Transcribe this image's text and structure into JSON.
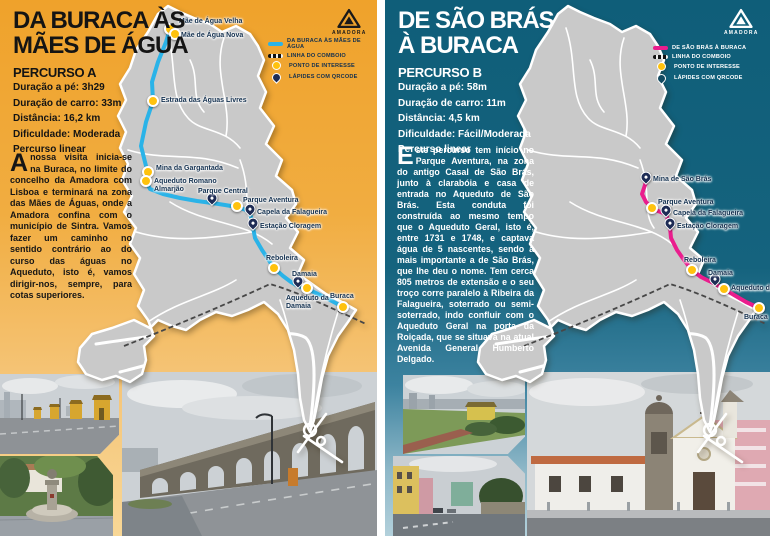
{
  "brand": {
    "logo_label": "AMADORA",
    "logo_icon": "amadora-triangle-emblem"
  },
  "panels": [
    {
      "title_lines": [
        "DA BURACA ÀS",
        "MÃES DE ÁGUA"
      ],
      "subtitle": "PERCURSO A",
      "stats": [
        "Duração a pé: 3h29",
        "Duração de carro: 33m",
        "Distância: 16,2 km",
        "Dificuldade: Moderada",
        "Percurso linear"
      ],
      "description": "A nossa visita inicia-se na Buraca, no limite do concelho da Amadora com Lisboa e terminará na zona das Mães de Águas, onde a Amadora confina com o município de Sintra. Vamos fazer um caminho no sentido contrário ao do curso das águas no Aqueduto, isto é, vamos dirigir-nos, sempre, para cotas superiores.",
      "legend": [
        {
          "symbol": "route",
          "label": "DA BURACA ÀS MÃES DE ÁGUA"
        },
        {
          "symbol": "train",
          "label": "LINHA DO COMBOIO"
        },
        {
          "symbol": "poi",
          "label": "PONTO DE INTERESSE"
        },
        {
          "symbol": "qr",
          "label": "LÁPIDES COM QRCODE"
        }
      ],
      "colors": {
        "route": "#2ab3e8",
        "background": "#efa22b"
      },
      "map": {
        "route": [
          [
            170,
            29
          ],
          [
            166,
            42
          ],
          [
            158,
            62
          ],
          [
            152,
            82
          ],
          [
            153,
            101
          ],
          [
            146,
            122
          ],
          [
            141,
            146
          ],
          [
            146,
            166
          ],
          [
            148,
            172
          ],
          [
            146,
            181
          ],
          [
            150,
            189
          ],
          [
            163,
            194
          ],
          [
            180,
            198
          ],
          [
            197,
            201
          ],
          [
            212,
            203
          ],
          [
            225,
            205
          ],
          [
            237,
            207
          ],
          [
            246,
            210
          ],
          [
            250,
            214
          ],
          [
            252,
            220
          ],
          [
            253,
            227
          ],
          [
            255,
            238
          ],
          [
            262,
            250
          ],
          [
            268,
            259
          ],
          [
            274,
            268
          ],
          [
            283,
            276
          ],
          [
            291,
            282
          ],
          [
            298,
            286
          ],
          [
            307,
            289
          ],
          [
            318,
            294
          ],
          [
            330,
            300
          ],
          [
            343,
            307
          ]
        ],
        "markers": [
          {
            "name": "Mãe de Água Velha",
            "type": "poi",
            "x": 170,
            "y": 29,
            "lx": 179,
            "ly": 18
          },
          {
            "name": "Mãe de Água Nova",
            "type": "poi",
            "x": 175,
            "y": 34,
            "lx": 181,
            "ly": 32
          },
          {
            "name": "Estrada das Águas Livres",
            "type": "poi",
            "x": 153,
            "y": 101,
            "lx": 161,
            "ly": 97
          },
          {
            "name": "Mina da Gargantada",
            "type": "poi",
            "x": 148,
            "y": 172,
            "lx": 156,
            "ly": 165
          },
          {
            "name": "Aqueduto Romano Almarjão",
            "type": "poi",
            "x": 146,
            "y": 181,
            "lx": 154,
            "ly": 178,
            "w": 68
          },
          {
            "name": "Parque Central",
            "type": "qr",
            "x": 212,
            "y": 202,
            "lx": 198,
            "ly": 188
          },
          {
            "name": "Parque Aventura",
            "type": "poi",
            "x": 237,
            "y": 206,
            "lx": 243,
            "ly": 197
          },
          {
            "name": "Capela da Falagueira",
            "type": "qr",
            "x": 250,
            "y": 213,
            "lx": 257,
            "ly": 209
          },
          {
            "name": "Estação Cloragem",
            "type": "qr",
            "x": 253,
            "y": 227,
            "lx": 260,
            "ly": 223
          },
          {
            "name": "Reboleira",
            "type": "poi",
            "x": 274,
            "y": 268,
            "lx": 266,
            "ly": 255
          },
          {
            "name": "Damaia",
            "type": "qr",
            "x": 298,
            "y": 285,
            "lx": 292,
            "ly": 271
          },
          {
            "name": "Aqueduto da Damaia",
            "type": "poi",
            "x": 307,
            "y": 288,
            "lx": 286,
            "ly": 295,
            "w": 58
          },
          {
            "name": "Buraca",
            "type": "poi",
            "x": 343,
            "y": 307,
            "lx": 330,
            "ly": 293
          }
        ]
      },
      "photos": [
        {
          "name": "street-with-aqueduct-guardhouses"
        },
        {
          "name": "fountain-square"
        },
        {
          "name": "aqueduct-arches-aguas-livres"
        }
      ]
    },
    {
      "title_lines": [
        "DE SÃO BRÁS",
        "À BURACA"
      ],
      "subtitle": "PERCURSO B",
      "stats": [
        "Duração a pé: 58m",
        "Duração de carro: 11m",
        "Distância: 4,5 km",
        "Dificuldade: Fácil/Moderada",
        "Percurso linear"
      ],
      "description": "Este percurso tem início no Parque Aventura, na zona do antigo Casal de São Brás, junto à clarabóia e casa de entrada no Aqueduto de São Brás. Esta conduta foi construída ao mesmo tempo que o Aqueduto Geral, isto é, entre 1731 e 1748, e captava água de 5 nascentes, sendo a mais importante a de São Brás, que lhe deu o nome. Tem cerca 805 metros de extensão e o seu troço corre paralelo à Ribeira da Falagueira, soterrado ou semi-soterrado, indo confluir com o Aqueduto Geral na porta da Roiçada, que se situava na atual Avenida General Humberto Delgado.",
      "legend": [
        {
          "symbol": "route",
          "label": "DE SÃO BRÁS À BURACA"
        },
        {
          "symbol": "train",
          "label": "LINHA DO COMBOIO"
        },
        {
          "symbol": "poi",
          "label": "PONTO DE INTERESSE"
        },
        {
          "symbol": "qr",
          "label": "LÁPIDES COM QRCODE"
        }
      ],
      "colors": {
        "route": "#ea1d8d",
        "background": "#0f5e79"
      },
      "map": {
        "route": [
          [
            246,
            182
          ],
          [
            242,
            194
          ],
          [
            246,
            202
          ],
          [
            252,
            208
          ],
          [
            258,
            211
          ],
          [
            266,
            214
          ],
          [
            268,
            220
          ],
          [
            270,
            227
          ],
          [
            271,
            238
          ],
          [
            277,
            250
          ],
          [
            284,
            260
          ],
          [
            292,
            270
          ],
          [
            301,
            277
          ],
          [
            309,
            281
          ],
          [
            315,
            284
          ],
          [
            324,
            289
          ],
          [
            334,
            295
          ],
          [
            346,
            302
          ],
          [
            359,
            308
          ]
        ],
        "markers": [
          {
            "name": "Mina de São Brás",
            "type": "qr",
            "x": 246,
            "y": 181,
            "lx": 253,
            "ly": 176
          },
          {
            "name": "Parque Aventura",
            "type": "poi",
            "x": 252,
            "y": 208,
            "lx": 258,
            "ly": 199
          },
          {
            "name": "Capela da Falagueira",
            "type": "qr",
            "x": 266,
            "y": 214,
            "lx": 273,
            "ly": 210
          },
          {
            "name": "Estação Cloragem",
            "type": "qr",
            "x": 270,
            "y": 227,
            "lx": 277,
            "ly": 223
          },
          {
            "name": "Reboleira",
            "type": "poi",
            "x": 292,
            "y": 270,
            "lx": 284,
            "ly": 257
          },
          {
            "name": "Damaia",
            "type": "qr",
            "x": 315,
            "y": 283,
            "lx": 308,
            "ly": 270
          },
          {
            "name": "Aqueduto da Damaia",
            "type": "poi",
            "x": 324,
            "y": 289,
            "lx": 331,
            "ly": 285
          },
          {
            "name": "Buraca",
            "type": "poi",
            "x": 359,
            "y": 308,
            "lx": 344,
            "ly": 314
          }
        ]
      },
      "photos": [
        {
          "name": "field-with-casal-sao-bras"
        },
        {
          "name": "street-view-falagueira"
        },
        {
          "name": "chapel-capela-sao-bras"
        }
      ]
    }
  ]
}
